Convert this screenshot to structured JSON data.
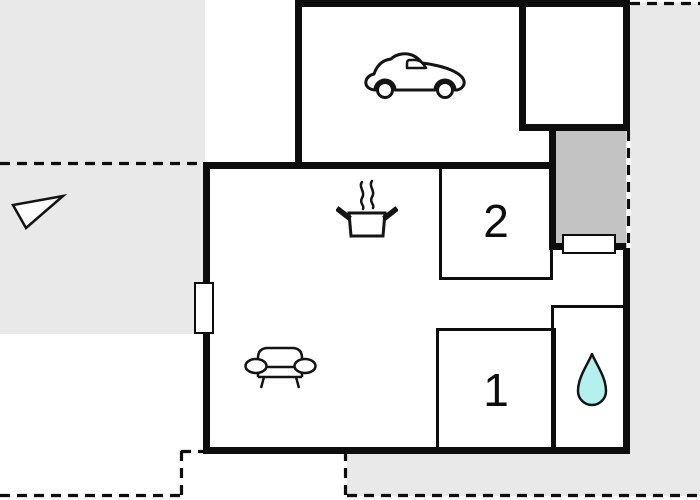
{
  "floorplan": {
    "rooms": [
      {
        "name": "bedroom-2",
        "label": "2"
      },
      {
        "name": "bedroom-1",
        "label": "1"
      }
    ],
    "icons": {
      "garage": "car-icon",
      "kitchen": "stove-icon",
      "living_area": "sofa-icon",
      "bathroom": "water-drop-icon",
      "orientation": "north-arrow-icon"
    },
    "colors": {
      "wall": "#0d0d0d",
      "outside_gray": "#e9e9e9",
      "terrace_gray": "#c3c3c3",
      "water_drop": "#b4f1ee",
      "background": "#ffffff"
    }
  }
}
